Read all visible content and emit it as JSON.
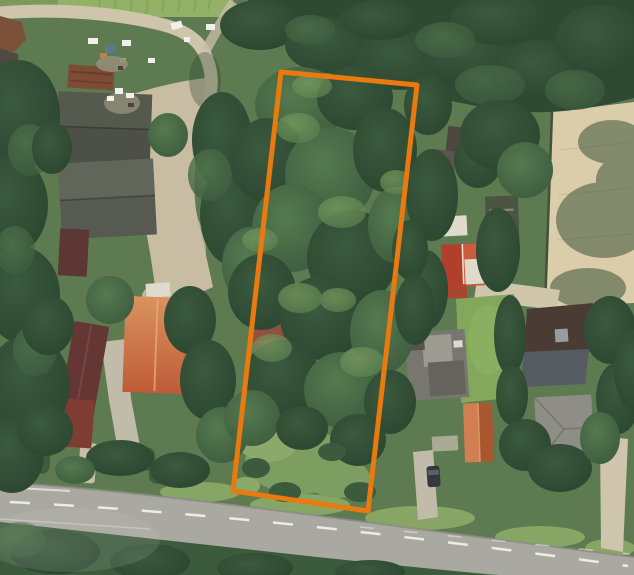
{
  "map": {
    "kind": "aerial-imagery",
    "overlay": "parcel-boundary"
  },
  "boundary": {
    "points": "281,72 417,85 368,511 233,491",
    "stroke_width": 5
  },
  "palette": {
    "boundary_color": "#e87a10",
    "base": "#5d7a50",
    "field": "#93b268",
    "field_row": "#7ca455",
    "grass_edge": "#7d9a5c",
    "canopy": "#2f4a33",
    "tree_dark1": "#3b5a3e",
    "tree_dark2": "#2c4630",
    "tree_mid1": "#557a4f",
    "tree_mid2": "#3d5c3f",
    "tree_light1": "#7fa263",
    "tree_light2": "#5d804f",
    "verge": "#8fae69",
    "clearing1": "#7d9e60",
    "clearing2": "#8aa96a",
    "shrub": "#3c5a3c",
    "dirt": "#c8bda2",
    "gravel": "#cfc5ac",
    "gravel2": "#c5bda4",
    "asphalt": "#a9a8a1",
    "road_edge": "#8b8a84",
    "marking": "#f2f2ee",
    "arena": "#dbcda9",
    "arena_line": "#cdbd96",
    "fence": "#44503e",
    "shadow": "#2e4a30",
    "rust": "#7e4c34",
    "rust_dark": "#5e3826",
    "barn1": "#4c5047",
    "barn1_light": "#5a5e52",
    "barn2": "#565a50",
    "barn2_light": "#676b5e",
    "maroon": "#5d3734",
    "white_s": "#dedacd",
    "salmon1": "#d9925f",
    "salmon2": "#bf5b38",
    "salmon_ridge": "#e6a873",
    "red_long": "#643634",
    "red_sq": "#7e3c32",
    "red_sq_dark": "#63302a",
    "parcel_house": "#915140",
    "parcel_house_dark": "#70402f",
    "red_roof": "#b23f2b",
    "red_roof_light": "#cd5b3d",
    "ridge_white": "#ece4d4",
    "stable": "#4b5542",
    "stable_mark": "#93a089",
    "shed1": "#4c4841",
    "shed2": "#5a564d",
    "court": "#cfc6ac",
    "lawn": "#83a75b",
    "lawn_light": "#93b766",
    "gray_light": "#9c9c93",
    "gray_mid": "#77776f",
    "gray_dark": "#64645c",
    "gray_small": "#54544c",
    "orange1": "#d08050",
    "orange2": "#a9572f",
    "orange_ridge": "#e19a66",
    "graphite1": "#4a3c35",
    "graphite2": "#555b61",
    "skylight": "#a0a6aa",
    "gray_house": "#8e8e86",
    "gray_house_line": "#75756d",
    "concrete": "#c1bbaa",
    "concrete2": "#bcb6a4",
    "car": "#35383c",
    "car_glass": "#596066",
    "junk_blue": "#5b7a88",
    "junk_orange": "#c28040",
    "junk_teal": "#4f7a6d",
    "junk_yellow": "#b9a85a",
    "junk_gray": "#958e7a",
    "junk_dark": "#4a4438",
    "white": "#f0f0ec",
    "brown_patch": "#7a5138",
    "dark_patch": "#4e4a40",
    "haze": "#cfd8c8"
  }
}
